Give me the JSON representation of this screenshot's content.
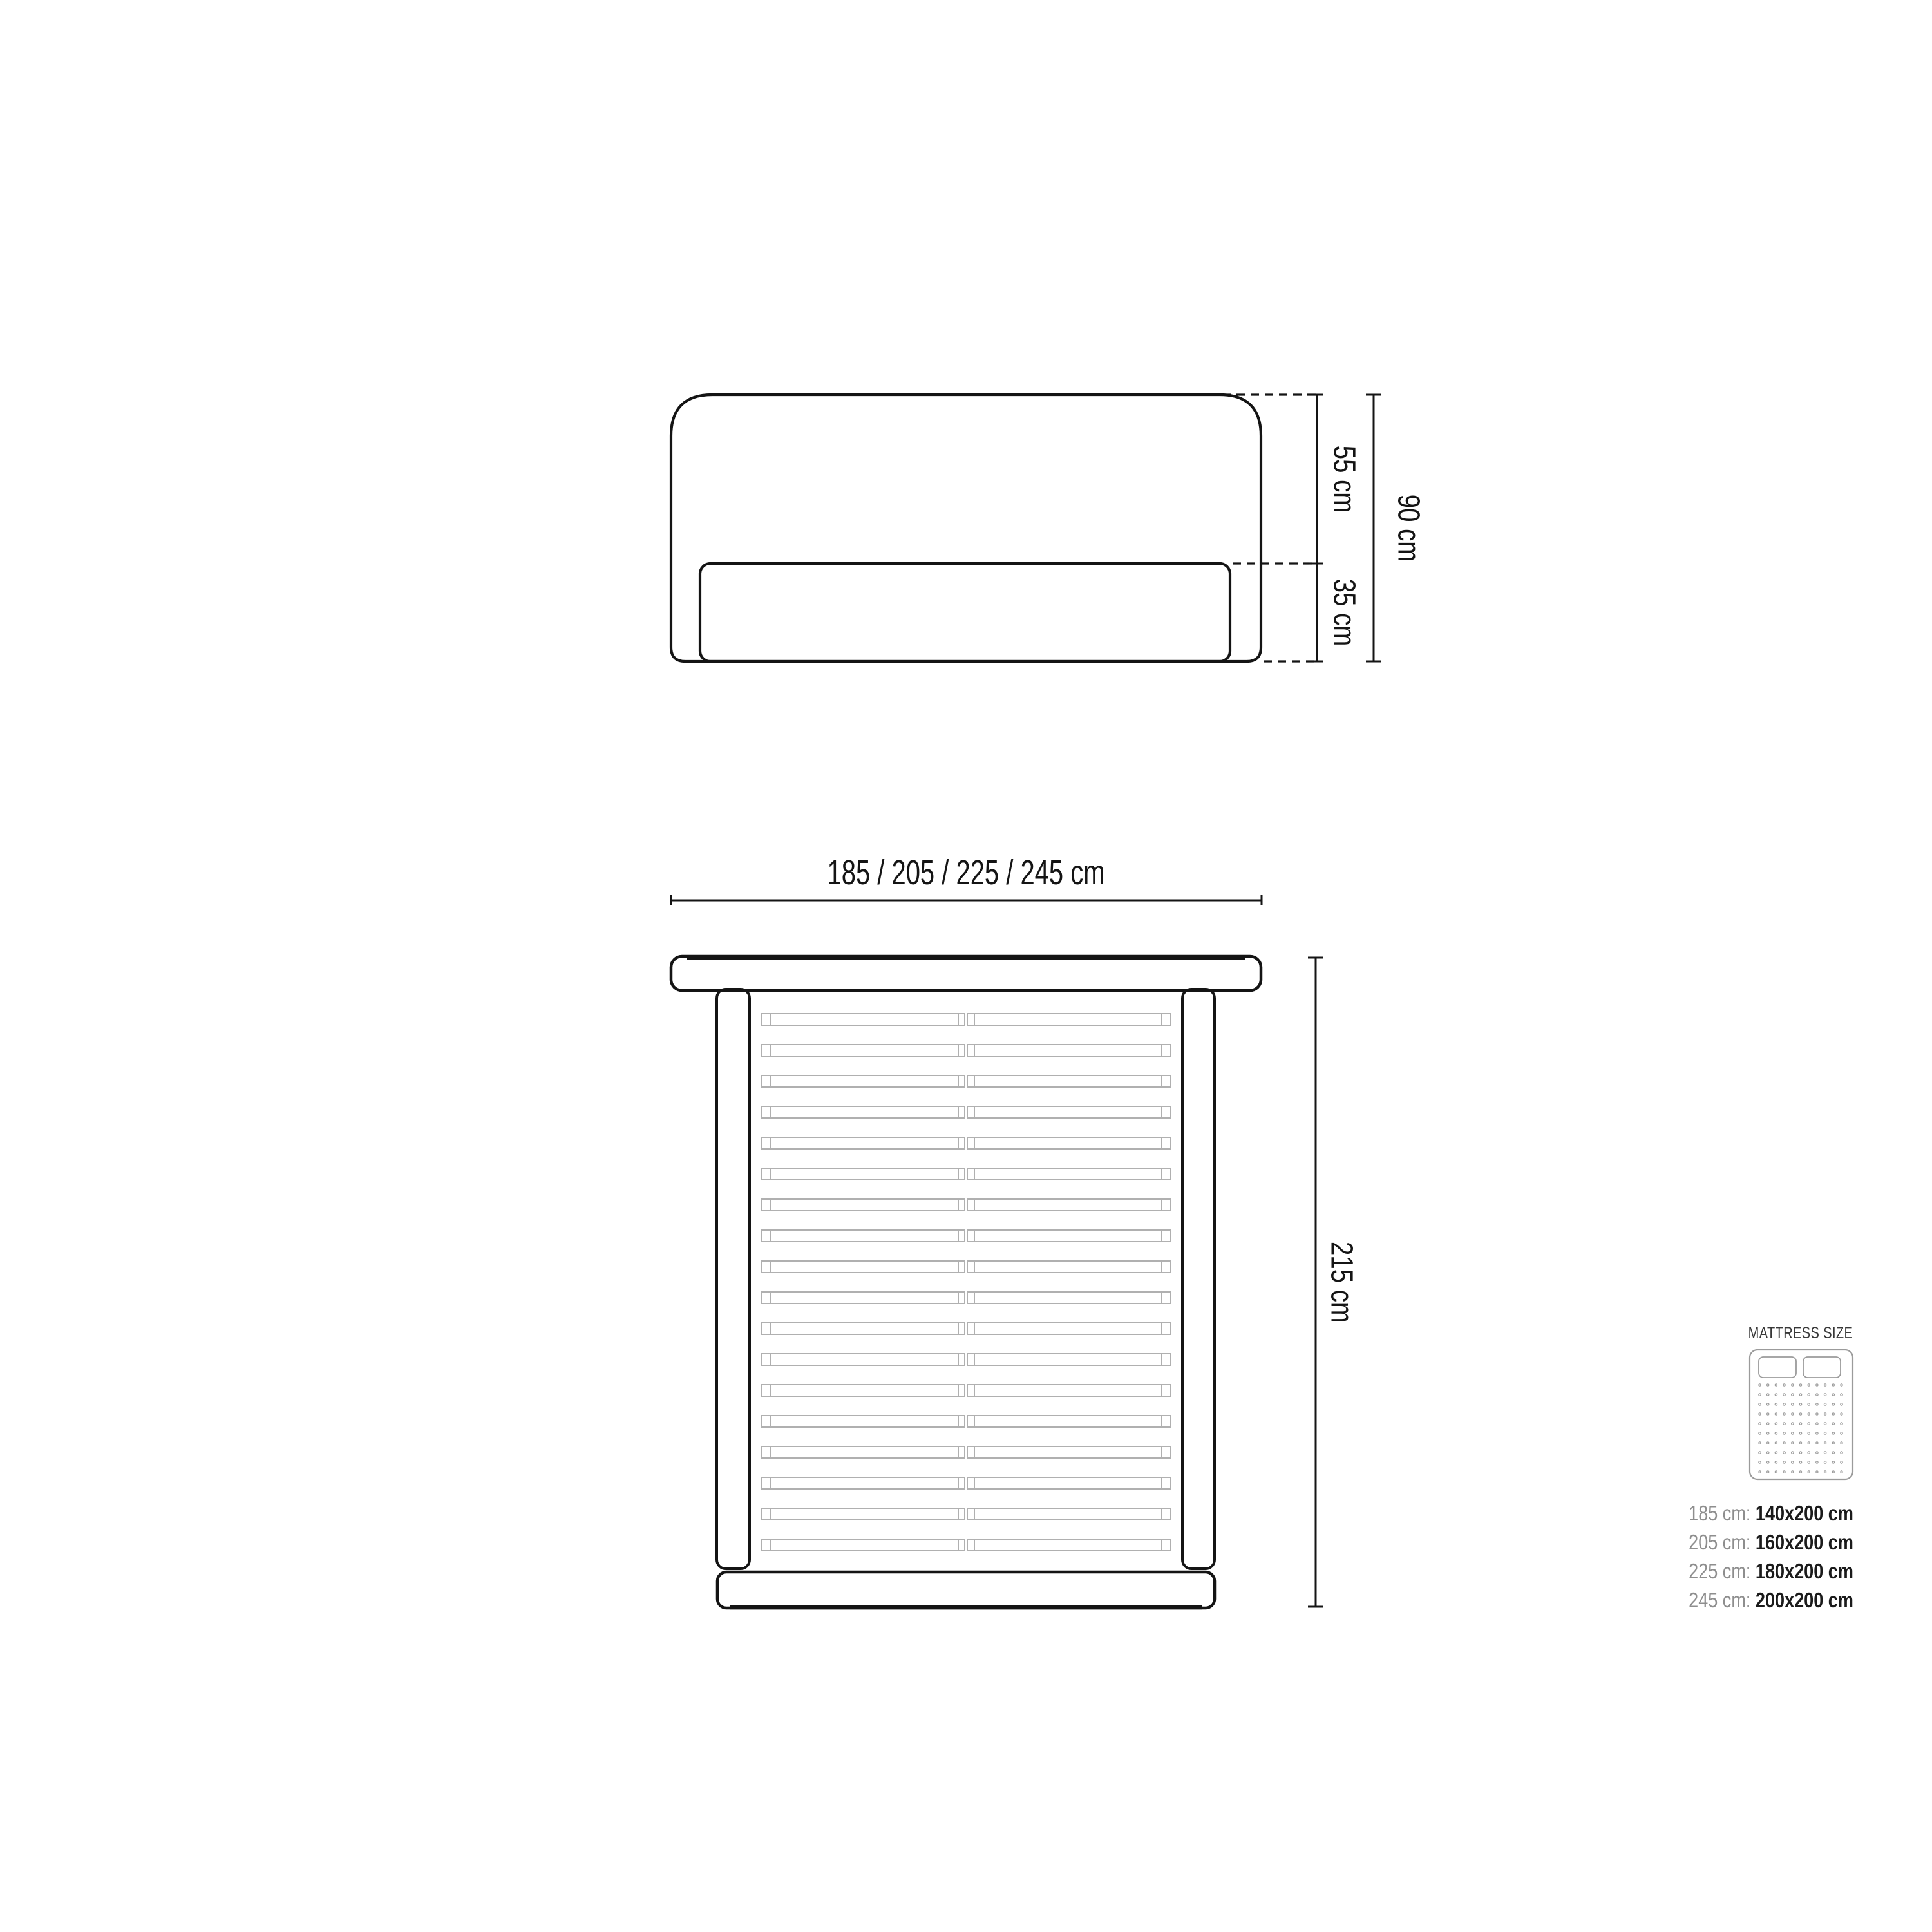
{
  "diagram_title": "bed-dimensions-technical-drawing",
  "front_view": {
    "headboard_height_label": "55 cm",
    "base_height_label": "35 cm",
    "total_height_label": "90 cm"
  },
  "top_view": {
    "width_label": "185 / 205 / 225 / 245 cm",
    "length_label": "215 cm",
    "slat_count": 18
  },
  "mattress_panel": {
    "title": "MATTRESS SIZE",
    "rows": [
      {
        "label": "185 cm:",
        "value": "140x200 cm"
      },
      {
        "label": "205 cm:",
        "value": "160x200 cm"
      },
      {
        "label": "225 cm:",
        "value": "180x200 cm"
      },
      {
        "label": "245 cm:",
        "value": "200x200 cm"
      }
    ],
    "icon": {
      "dot_cols": 11,
      "dot_rows": 10
    }
  },
  "colors": {
    "line": "#141414",
    "slat": "#b0b0b0",
    "icon_stroke": "#9b9b9b",
    "muted_text": "#8e8e8e",
    "dark_text": "#1b1b1b",
    "title_text": "#383838"
  }
}
